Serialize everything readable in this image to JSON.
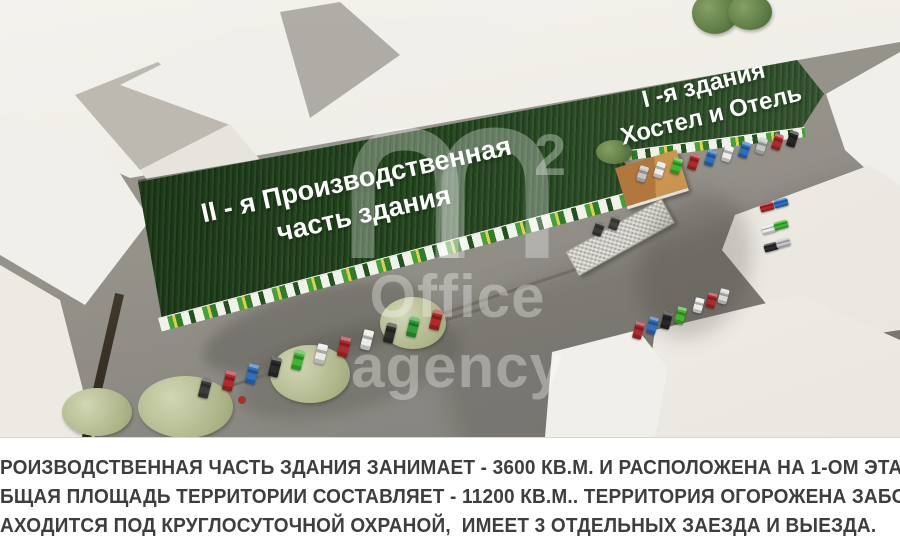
{
  "scene": {
    "labels": {
      "part2": {
        "line1": "II - я Производственная",
        "line2": "часть здания"
      },
      "part1": {
        "line1": "I -я здания",
        "line2": "Хостел и Отель"
      }
    },
    "watermark": {
      "sup": "2",
      "line1": "Office",
      "line2": "agency"
    }
  },
  "info": {
    "line1": "РОИЗВОДСТВЕННАЯ ЧАСТЬ ЗДАНИЯ ЗАНИМАЕТ - 3600 КВ.М. И РАСПОЛОЖЕНА НА 1-ОМ ЭТА",
    "line2": "БЩАЯ ПЛОЩАДЬ ТЕРРИТОРИИ СОСТАВЛЯЕТ - 11200 КВ.М.. ТЕРРИТОРИЯ ОГОРОЖЕНА ЗАБОР",
    "line3": "АХОДИТСЯ ПОД КРУГЛОСУТОЧНОЙ ОХРАНОЙ,  ИМЕЕТ 3 ОТДЕЛЬНЫХ ЗАЕЗДА И ВЫЕЗДА."
  },
  "colors": {
    "roof_green": "#2b4926",
    "facade_green": "#3fa337",
    "info_text": "#3e3e3e",
    "ground_gray": "#918f89",
    "building_white": "#f1efe9"
  }
}
